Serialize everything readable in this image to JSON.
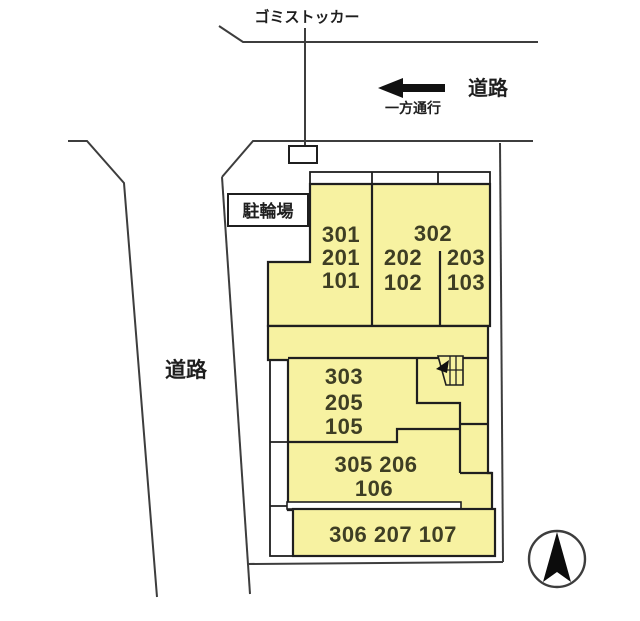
{
  "labels": {
    "garbage_storage": "ゴミストッカー",
    "road_right": "道路",
    "one_way": "一方通行",
    "road_left": "道路",
    "bicycle_parking": "駐輪場"
  },
  "units": {
    "block_nw": [
      "301",
      "201",
      "101"
    ],
    "block_ne_top": "302",
    "block_ne_left": [
      "202",
      "102"
    ],
    "block_ne_right": [
      "203",
      "103"
    ],
    "block_mid": [
      "303",
      "205",
      "105"
    ],
    "block_south": [
      "305 206",
      "106"
    ],
    "block_bottom": "306 207 107"
  },
  "colors": {
    "building_fill": "#f7f2a1",
    "wall_line": "#1f1f1f",
    "site_line": "#3d3d3d",
    "unit_text": "#3e3e24"
  }
}
